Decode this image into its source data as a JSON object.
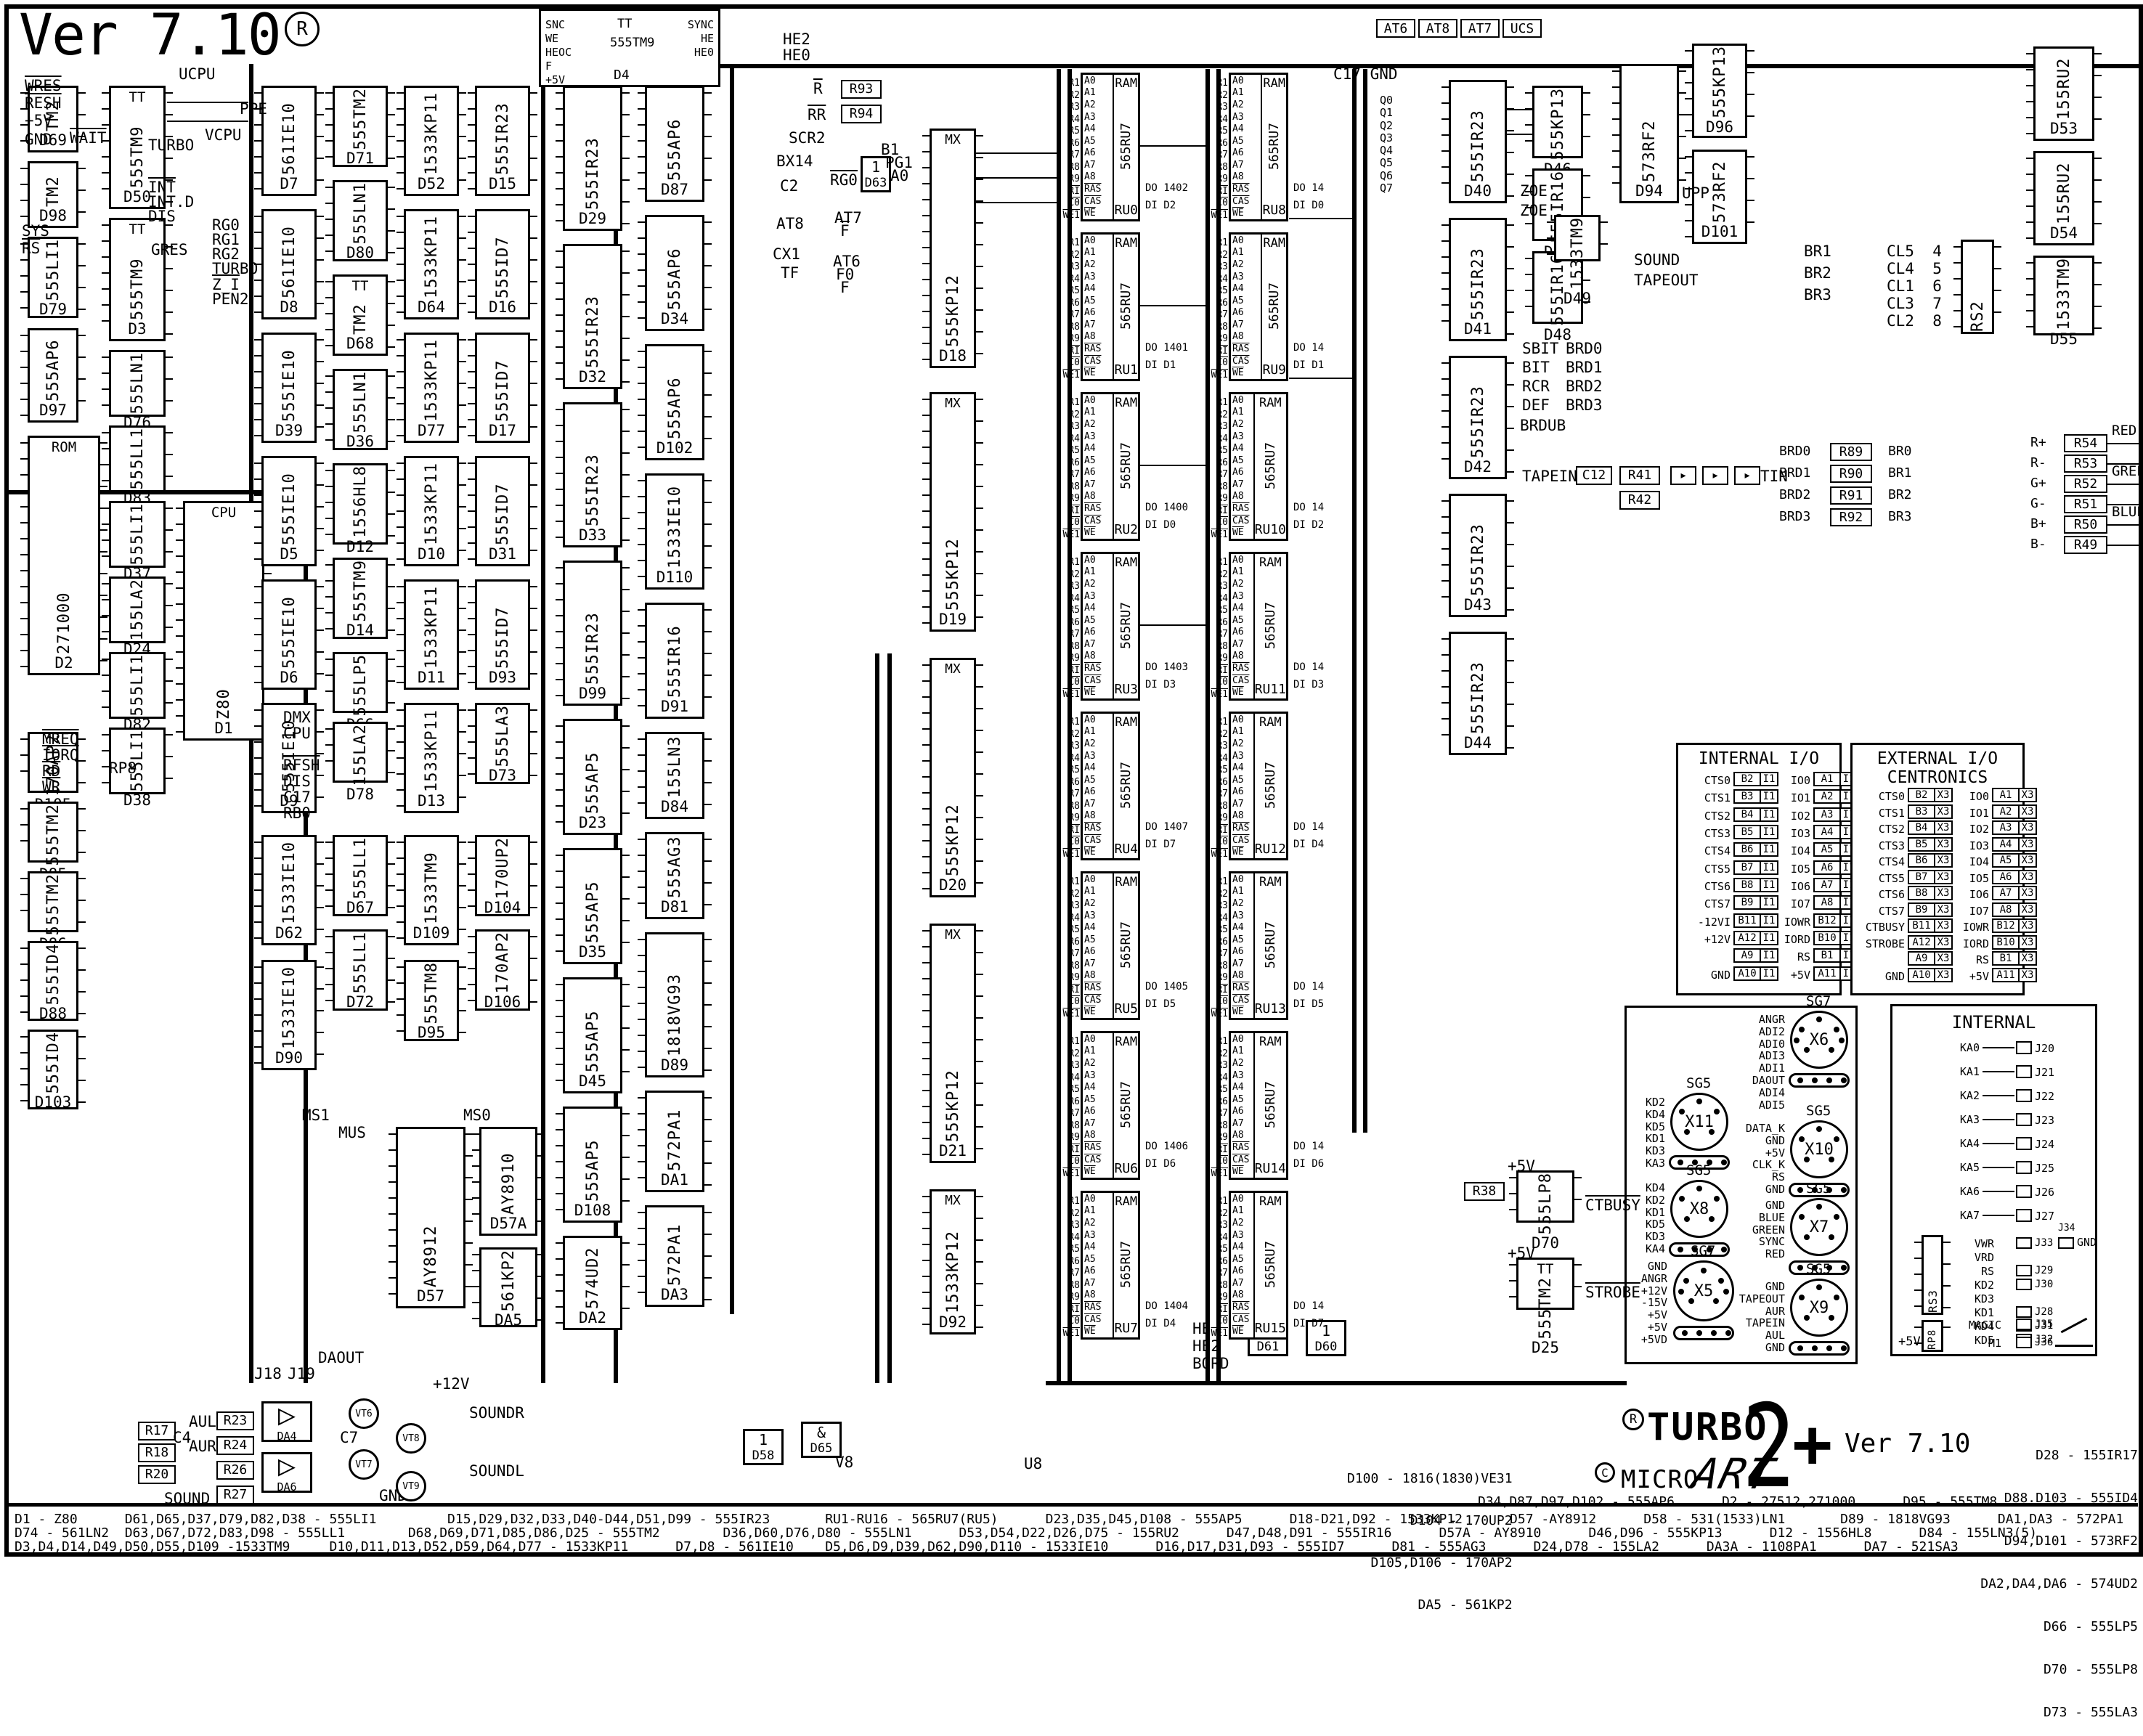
{
  "meta": {
    "version": "Ver 7.10",
    "reg": "R"
  },
  "logo": {
    "r": "R",
    "c": "C",
    "turbo": "TURBO",
    "micro": "MICRO",
    "art": "ART",
    "two": "2",
    "plus": "+",
    "version": "Ver 7.10"
  },
  "top_boxes": [
    "AT6",
    "AT8",
    "AT7",
    "UCS"
  ],
  "sync_block": {
    "ref": "D4",
    "part": "555TM9",
    "tt": "TT",
    "left": [
      "SNC",
      "~WE",
      "HEOC",
      "F",
      "+5V"
    ],
    "right": [
      "SYNC",
      "HE",
      "HE0"
    ]
  },
  "q_stack": [
    "Q0",
    "Q1",
    "Q2",
    "Q3",
    "Q4",
    "Q5",
    "Q6",
    "Q7"
  ],
  "labels": [
    {
      "t": "WRES",
      "ov": true
    },
    {
      "t": "RESH",
      "ov": true
    },
    {
      "t": "+5V"
    },
    {
      "t": "GND"
    },
    {
      "t": "UCPU"
    },
    {
      "t": "VCPU"
    },
    {
      "t": "PPE"
    },
    {
      "t": "GRES"
    },
    {
      "t": "SYS"
    },
    {
      "t": "RS",
      "ov": true
    },
    {
      "t": "WAIT",
      "ov": true
    },
    {
      "t": "TURBO"
    },
    {
      "t": "INT",
      "ov": true
    },
    {
      "t": "INT.D"
    },
    {
      "t": "DIS"
    },
    {
      "t": "RG0"
    },
    {
      "t": "RG1"
    },
    {
      "t": "RG2"
    },
    {
      "t": "TURBO"
    },
    {
      "t": "Z_I",
      "ov": true
    },
    {
      "t": "PEN2"
    },
    {
      "t": "MREQ",
      "ov": true
    },
    {
      "t": "IORQ",
      "ov": true
    },
    {
      "t": "RD",
      "ov": true
    },
    {
      "t": "WR",
      "ov": true
    },
    {
      "t": "DMX"
    },
    {
      "t": "CPU"
    },
    {
      "t": "RFSH",
      "ov": true
    },
    {
      "t": "DIS"
    },
    {
      "t": "C17"
    },
    {
      "t": "RB0"
    },
    {
      "t": "RP8"
    },
    {
      "t": "SCR2"
    },
    {
      "t": "B1"
    },
    {
      "t": "PG1"
    },
    {
      "t": "A0"
    },
    {
      "t": "RG0",
      "ov": true
    },
    {
      "t": "AT7"
    },
    {
      "t": "F",
      "ov": true
    },
    {
      "t": "AT6"
    },
    {
      "t": "F0"
    },
    {
      "t": "F"
    },
    {
      "t": "C2"
    },
    {
      "t": "AT8"
    },
    {
      "t": "CX1"
    },
    {
      "t": "TF"
    },
    {
      "t": "BX14"
    },
    {
      "t": "R",
      "ov": true
    },
    {
      "t": "RR",
      "ov": true
    },
    {
      "t": "HE2"
    },
    {
      "t": "HE0"
    },
    {
      "t": "HE"
    },
    {
      "t": "HE2"
    },
    {
      "t": "BORD"
    },
    {
      "t": "V8"
    },
    {
      "t": "U8"
    },
    {
      "t": "C17 GND"
    },
    {
      "t": "ZOE"
    },
    {
      "t": "ZOE"
    },
    {
      "t": "SBIT"
    },
    {
      "t": "BIT"
    },
    {
      "t": "RCR"
    },
    {
      "t": "DEF"
    },
    {
      "t": "BRDUB"
    },
    {
      "t": "BRD0"
    },
    {
      "t": "BRD1"
    },
    {
      "t": "BRD2"
    },
    {
      "t": "BRD3"
    },
    {
      "t": "SOUND"
    },
    {
      "t": "TAPEOUT"
    },
    {
      "t": "TAPEIN"
    },
    {
      "t": "TIN"
    },
    {
      "t": "UPP"
    },
    {
      "t": "CTBUSY",
      "ov": true
    },
    {
      "t": "STROBE",
      "ov": true
    },
    {
      "t": "+5V"
    },
    {
      "t": "+5V"
    },
    {
      "t": "MS1"
    },
    {
      "t": "MS0"
    },
    {
      "t": "MUS"
    },
    {
      "t": "+12V"
    },
    {
      "t": "SOUNDR"
    },
    {
      "t": "SOUNDL"
    },
    {
      "t": "SOUND"
    },
    {
      "t": "AUL"
    },
    {
      "t": "AUR"
    },
    {
      "t": "DAOUT"
    },
    {
      "t": "GND"
    },
    {
      "t": "J18"
    },
    {
      "t": "J19"
    },
    {
      "t": "C4"
    },
    {
      "t": "C7"
    },
    {
      "t": "BR1"
    },
    {
      "t": "BR2"
    },
    {
      "t": "BR3"
    },
    {
      "t": "CL5  4"
    },
    {
      "t": "CL4  5"
    },
    {
      "t": "CL1  6"
    },
    {
      "t": "CL3  7"
    },
    {
      "t": "CL2  8"
    }
  ],
  "ics": [
    {
      "ref": "D69",
      "part": "TM2"
    },
    {
      "ref": "D98",
      "part": "TM2"
    },
    {
      "ref": "D79",
      "part": "555LI1"
    },
    {
      "ref": "D97",
      "part": "555AP6"
    },
    {
      "ref": "D105",
      "part": "170AP2"
    },
    {
      "ref": "D85",
      "part": "555TM2"
    },
    {
      "ref": "D86",
      "part": "555TM2"
    },
    {
      "ref": "D88",
      "part": "555ID4"
    },
    {
      "ref": "D103",
      "part": "555ID4"
    },
    {
      "ref": "D2",
      "part": "271000",
      "side": "ROM"
    },
    {
      "ref": "D50",
      "part": "555TM9",
      "side": "TT"
    },
    {
      "ref": "D3",
      "part": "555TM9",
      "side": "TT"
    },
    {
      "ref": "D76",
      "part": "555LN1"
    },
    {
      "ref": "D83",
      "part": "555LL1"
    },
    {
      "ref": "D37",
      "part": "555LI1"
    },
    {
      "ref": "D24",
      "part": "155LA2"
    },
    {
      "ref": "D82",
      "part": "555LI1"
    },
    {
      "ref": "D38",
      "part": "555LI1"
    },
    {
      "ref": "D1",
      "part": "Z80",
      "side": "CPU"
    },
    {
      "ref": "D7",
      "part": "561IE10"
    },
    {
      "ref": "D8",
      "part": "561IE10"
    },
    {
      "ref": "D39",
      "part": "555IE10"
    },
    {
      "ref": "D5",
      "part": "555IE10"
    },
    {
      "ref": "D6",
      "part": "555IE10"
    },
    {
      "ref": "D9",
      "part": "555IE10"
    },
    {
      "ref": "D71",
      "part": "555TM2"
    },
    {
      "ref": "D80",
      "part": "555LN1"
    },
    {
      "ref": "D68",
      "part": "TM2",
      "side": "TT"
    },
    {
      "ref": "D36",
      "part": "555LN1"
    },
    {
      "ref": "D12",
      "part": "1556HL8"
    },
    {
      "ref": "D14",
      "part": "555TM9"
    },
    {
      "ref": "D66",
      "part": "555LP5"
    },
    {
      "ref": "D78",
      "part": "155LA2"
    },
    {
      "ref": "D52",
      "part": "1533KP11"
    },
    {
      "ref": "D64",
      "part": "1533KP11"
    },
    {
      "ref": "D77",
      "part": "1533KP11"
    },
    {
      "ref": "D10",
      "part": "1533KP11"
    },
    {
      "ref": "D11",
      "part": "1533KP11"
    },
    {
      "ref": "D13",
      "part": "1533KP11"
    },
    {
      "ref": "D15",
      "part": "555IR23"
    },
    {
      "ref": "D16",
      "part": "555ID7"
    },
    {
      "ref": "D17",
      "part": "555ID7"
    },
    {
      "ref": "D31",
      "part": "555ID7"
    },
    {
      "ref": "D93",
      "part": "555ID7"
    },
    {
      "ref": "D73",
      "part": "555LA3"
    },
    {
      "ref": "D62",
      "part": "1533IE10"
    },
    {
      "ref": "D90",
      "part": "1533IE10"
    },
    {
      "ref": "D67",
      "part": "555LL1"
    },
    {
      "ref": "D72",
      "part": "555LL1"
    },
    {
      "ref": "D109",
      "part": "1533TM9"
    },
    {
      "ref": "D95",
      "part": "555TM8"
    },
    {
      "ref": "D104",
      "part": "170UP2"
    },
    {
      "ref": "D106",
      "part": "170AP2"
    },
    {
      "ref": "D29",
      "part": "555IR23"
    },
    {
      "ref": "D32",
      "part": "555IR23"
    },
    {
      "ref": "D33",
      "part": "555IR23"
    },
    {
      "ref": "D99",
      "part": "555IR23"
    },
    {
      "ref": "D23",
      "part": "555AP5"
    },
    {
      "ref": "D35",
      "part": "555AP5"
    },
    {
      "ref": "D45",
      "part": "555AP5"
    },
    {
      "ref": "D108",
      "part": "555AP5"
    },
    {
      "ref": "D87",
      "part": "555AP6"
    },
    {
      "ref": "D34",
      "part": "555AP6"
    },
    {
      "ref": "D102",
      "part": "555AP6"
    },
    {
      "ref": "D110",
      "part": "1533IE10"
    },
    {
      "ref": "D91",
      "part": "555IR16"
    },
    {
      "ref": "D84",
      "part": "155LN3"
    },
    {
      "ref": "D81",
      "part": "555AG3"
    },
    {
      "ref": "D89",
      "part": "1818VG93"
    },
    {
      "ref": "DA1",
      "part": "572PA1"
    },
    {
      "ref": "DA3",
      "part": "572PA1"
    },
    {
      "ref": "DA2",
      "part": "574UD2"
    },
    {
      "ref": "D18",
      "part": "555KP12",
      "inner": "MX"
    },
    {
      "ref": "D19",
      "part": "555KP12",
      "inner": "MX"
    },
    {
      "ref": "D20",
      "part": "555KP12",
      "inner": "MX"
    },
    {
      "ref": "D21",
      "part": "555KP12",
      "inner": "MX"
    },
    {
      "ref": "D92",
      "part": "1533KP12",
      "inner": "MX"
    },
    {
      "ref": "D40",
      "part": "555IR23"
    },
    {
      "ref": "D41",
      "part": "555IR23"
    },
    {
      "ref": "D42",
      "part": "555IR23"
    },
    {
      "ref": "D43",
      "part": "555IR23"
    },
    {
      "ref": "D44",
      "part": "555IR23"
    },
    {
      "ref": "D46",
      "part": "555KP13"
    },
    {
      "ref": "D47",
      "part": "555IR16"
    },
    {
      "ref": "D48",
      "part": "555IR16"
    },
    {
      "ref": "D94",
      "part": "573RF2"
    },
    {
      "ref": "D49",
      "part": "1533TM9"
    },
    {
      "ref": "D96",
      "part": "555KP13"
    },
    {
      "ref": "D101",
      "part": "573RF2"
    },
    {
      "ref": "D53",
      "part": "155RU2"
    },
    {
      "ref": "D54",
      "part": "155RU2"
    },
    {
      "ref": "D55",
      "part": "1533TM9"
    },
    {
      "ref": "D57",
      "part": "AY8912"
    },
    {
      "ref": "D57A",
      "part": "AY8910"
    },
    {
      "ref": "DA5",
      "part": "561KP2"
    },
    {
      "ref": "D25",
      "part": "555TM2",
      "side": "TT"
    },
    {
      "ref": "D70",
      "part": "555LP8"
    }
  ],
  "gates": [
    {
      "ref": "D63",
      "glyph": "1"
    },
    {
      "ref": "D58",
      "glyph": "1"
    },
    {
      "ref": "D65",
      "glyph": "&"
    },
    {
      "ref": "D61",
      "glyph": "&"
    },
    {
      "ref": "D60",
      "glyph": "1"
    }
  ],
  "rboxes": [
    "R93",
    "R94",
    "R38",
    "R41",
    "R42",
    "C12",
    "R17",
    "R18",
    "R20",
    "R23",
    "R24",
    "R26",
    "R27"
  ],
  "ram": {
    "title": "RAM",
    "part": "565RU7",
    "addr": [
      "A0",
      "A1",
      "A2",
      "A3",
      "A4",
      "A5",
      "A6",
      "A7",
      "A8",
      "~RAS",
      "~CAS",
      "~WE"
    ],
    "row_sigs": [
      "R1",
      "R2",
      "R3",
      "R4",
      "R5",
      "R6",
      "R7",
      "R8",
      "R9",
      "~RI",
      "~C0",
      "~WE1"
    ],
    "do_label": "DO",
    "di_label": "DI",
    "left": [
      {
        "name": "RU0",
        "do": "1402",
        "di": "D2"
      },
      {
        "name": "RU1",
        "do": "1401",
        "di": "D1"
      },
      {
        "name": "RU2",
        "do": "1400",
        "di": "D0"
      },
      {
        "name": "RU3",
        "do": "1403",
        "di": "D3"
      },
      {
        "name": "RU4",
        "do": "1407",
        "di": "D7"
      },
      {
        "name": "RU5",
        "do": "1405",
        "di": "D5"
      },
      {
        "name": "RU6",
        "do": "1406",
        "di": "D6"
      },
      {
        "name": "RU7",
        "do": "1404",
        "di": "D4"
      }
    ],
    "right": [
      {
        "name": "RU8",
        "do": "14",
        "di": "D0"
      },
      {
        "name": "RU9",
        "do": "14",
        "di": "D1"
      },
      {
        "name": "RU10",
        "do": "14",
        "di": "D2"
      },
      {
        "name": "RU11",
        "do": "14",
        "di": "D3"
      },
      {
        "name": "RU12",
        "do": "14",
        "di": "D4"
      },
      {
        "name": "RU13",
        "do": "14",
        "di": "D5"
      },
      {
        "name": "RU14",
        "do": "14",
        "di": "D6"
      },
      {
        "name": "RU15",
        "do": "14",
        "di": "D7"
      }
    ]
  },
  "rs2": "RS2",
  "io_internal": {
    "title": "INTERNAL I/O",
    "tag": "I1",
    "left_rows": [
      [
        "CTS0",
        "B2"
      ],
      [
        "CTS1",
        "B3"
      ],
      [
        "CTS2",
        "B4"
      ],
      [
        "CTS3",
        "B5"
      ],
      [
        "CTS4",
        "B6"
      ],
      [
        "CTS5",
        "B7"
      ],
      [
        "CTS6",
        "B8"
      ],
      [
        "CTS7",
        "B9"
      ],
      [
        "-12VI",
        "B11"
      ],
      [
        "+12V",
        "A12"
      ],
      [
        "",
        "A9"
      ],
      [
        "GND",
        "A10"
      ]
    ],
    "right_rows": [
      [
        "IO0",
        "A1"
      ],
      [
        "IO1",
        "A2"
      ],
      [
        "IO2",
        "A3"
      ],
      [
        "IO3",
        "A4"
      ],
      [
        "IO4",
        "A5"
      ],
      [
        "IO5",
        "A6"
      ],
      [
        "IO6",
        "A7"
      ],
      [
        "IO7",
        "A8"
      ],
      [
        "~IOWR",
        "B12"
      ],
      [
        "~IORD",
        "B10"
      ],
      [
        "~RS",
        "B1"
      ],
      [
        "+5V",
        "A11"
      ]
    ]
  },
  "io_external": {
    "title": "EXTERNAL I/O",
    "subtitle": "CENTRONICS",
    "tag": "X3",
    "left_rows": [
      [
        "CTS0",
        "B2"
      ],
      [
        "CTS1",
        "B3"
      ],
      [
        "CTS2",
        "B4"
      ],
      [
        "CTS3",
        "B5"
      ],
      [
        "CTS4",
        "B6"
      ],
      [
        "CTS5",
        "B7"
      ],
      [
        "CTS6",
        "B8"
      ],
      [
        "CTS7",
        "B9"
      ],
      [
        "~CTBUSY",
        "B11"
      ],
      [
        "~STROBE",
        "A12"
      ],
      [
        "",
        "A9"
      ],
      [
        "GND",
        "A10"
      ]
    ],
    "right_rows": [
      [
        "IO0",
        "A1"
      ],
      [
        "IO1",
        "A2"
      ],
      [
        "IO2",
        "A3"
      ],
      [
        "IO3",
        "A4"
      ],
      [
        "IO4",
        "A5"
      ],
      [
        "IO5",
        "A6"
      ],
      [
        "IO6",
        "A7"
      ],
      [
        "IO7",
        "A8"
      ],
      [
        "~IOWR",
        "B12"
      ],
      [
        "~IORD",
        "B10"
      ],
      [
        "~RS",
        "B1"
      ],
      [
        "+5V",
        "A11"
      ]
    ]
  },
  "internal_box": {
    "title": "INTERNAL",
    "ka_rows": [
      [
        "KA0",
        "J20"
      ],
      [
        "KA1",
        "J21"
      ],
      [
        "KA2",
        "J22"
      ],
      [
        "KA3",
        "J23"
      ],
      [
        "KA4",
        "J24"
      ],
      [
        "KA5",
        "J25"
      ],
      [
        "KA6",
        "J26"
      ],
      [
        "KA7",
        "J27"
      ]
    ],
    "mid_rows": [
      [
        "~VWR",
        "J33"
      ],
      [
        "~VRD",
        ""
      ],
      [
        "~RS",
        "J29"
      ],
      [
        "KD2",
        "J30"
      ],
      [
        "KD3",
        ""
      ],
      [
        "KD1",
        "J28"
      ],
      [
        "KD4",
        "J31"
      ],
      [
        "KD5",
        "J32"
      ]
    ],
    "rs3": "RS3",
    "rp8": "RP8",
    "plus5": "+5V",
    "gnd": "GND",
    "gnd_conn": "J34",
    "magic": [
      "MAGIC",
      "J35"
    ],
    "m1": [
      "~M1",
      "J36"
    ]
  },
  "connectors": [
    {
      "type": "SG7",
      "name": "X6",
      "signals": [
        "ANGR",
        "ADI2",
        "ADI0",
        "ADI3",
        "ADI1",
        "DAOUT",
        "ADI4",
        "ADI5"
      ]
    },
    {
      "type": "SG5",
      "name": "X11",
      "signals": [
        "KD2",
        "KD4",
        "KD5",
        "KD1",
        "KD3",
        "KA3"
      ]
    },
    {
      "type": "SG5",
      "name": "X10",
      "signals": [
        "DATA_K",
        "GND",
        "+5V",
        "CLK_K",
        "~RS",
        "GND"
      ]
    },
    {
      "type": "SG5",
      "name": "X8",
      "signals": [
        "KD4",
        "KD2",
        "KD1",
        "KD5",
        "KD3",
        "KA4"
      ]
    },
    {
      "type": "SG5",
      "name": "X7",
      "signals": [
        "GND",
        "BLUE",
        "GREEN",
        "SYNC",
        "RED"
      ]
    },
    {
      "type": "SG7",
      "name": "X5",
      "signals": [
        "GND",
        "ANGR",
        "+12V",
        "-15V",
        "+5V",
        "+5V",
        "+5VD"
      ]
    },
    {
      "type": "SG5",
      "name": "X9",
      "signals": [
        "GND",
        "TAPEOUT",
        "AUR",
        "TAPEIN",
        "AUL",
        "GND"
      ]
    }
  ],
  "rgb_block": [
    {
      "in": "R+",
      "r": "R54",
      "out": "RED"
    },
    {
      "in": "R-",
      "r": "R53",
      "out": ""
    },
    {
      "in": "G+",
      "r": "R52",
      "out": "GREEN"
    },
    {
      "in": "G-",
      "r": "R51",
      "out": ""
    },
    {
      "in": "B+",
      "r": "R50",
      "out": "BLUE"
    },
    {
      "in": "B-",
      "r": "R49",
      "out": ""
    }
  ],
  "brd_block": [
    {
      "in": "BRD0",
      "r": "R89",
      "out": "BR0"
    },
    {
      "in": "BRD1",
      "r": "R90",
      "out": "BR1"
    },
    {
      "in": "BRD2",
      "r": "R91",
      "out": "BR2"
    },
    {
      "in": "BRD3",
      "r": "R92",
      "out": "BR3"
    }
  ],
  "sound_refs": {
    "da4": "DA4",
    "da6": "DA6",
    "vts": [
      "VT6",
      "VT7",
      "VT8",
      "VT9"
    ]
  },
  "parts": {
    "bottom": [
      "D1 - Z80      D61,D65,D37,D79,D82,D38 - 555LI1         D15,D29,D32,D33,D40-D44,D51,D99 - 555IR23       RU1-RU16 - 565RU7(RU5)      D23,D35,D45,D108 - 555AP5      D18-D21,D92 - 1533KP12      D57 -AY8912      D58 - 531(1533)LN1       D89 - 1818VG93      DA1,DA3 - 572PA1",
      "D74 - 561LN2  D63,D67,D72,D83,D98 - 555LL1        D68,D69,D71,D85,D86,D25 - 555TM2        D36,D60,D76,D80 - 555LN1      D53,D54,D22,D26,D75 - 155RU2      D47,D48,D91 - 555IR16      D57A - AY8910      D46,D96 - 555KP13      D12 - 1556HL8      D84 - 155LN3(5)",
      "D3,D4,D14,D49,D50,D55,D109 -1533TM9     D10,D11,D13,D52,D59,D64,D77 - 1533KP11      D7,D8 - 561IE10    D5,D6,D9,D39,D62,D90,D110 - 1533IE10      D16,D17,D31,D93 - 555ID7      D81 - 555AG3      D24,D78 - 155LA2      DA3A - 1108PA1      DA7 - 521SA3"
    ],
    "mid": [
      "D100 - 1816(1830)VE31",
      "D104 - 170UP2",
      "D105,D106 - 170AP2",
      "DA5 - 561KP2"
    ],
    "mid2": "D34,D87,D97,D102 - 555AP6      D2 - 27512,271000      D95 - 555TM8",
    "right": [
      "D28 - 155IR17",
      "D88.D103 - 555ID4",
      "D94,D101 - 573RF2",
      "DA2,DA4,DA6 - 574UD2",
      "D66 - 555LP5",
      "D70 - 555LP8",
      "D73 - 555LA3"
    ]
  }
}
